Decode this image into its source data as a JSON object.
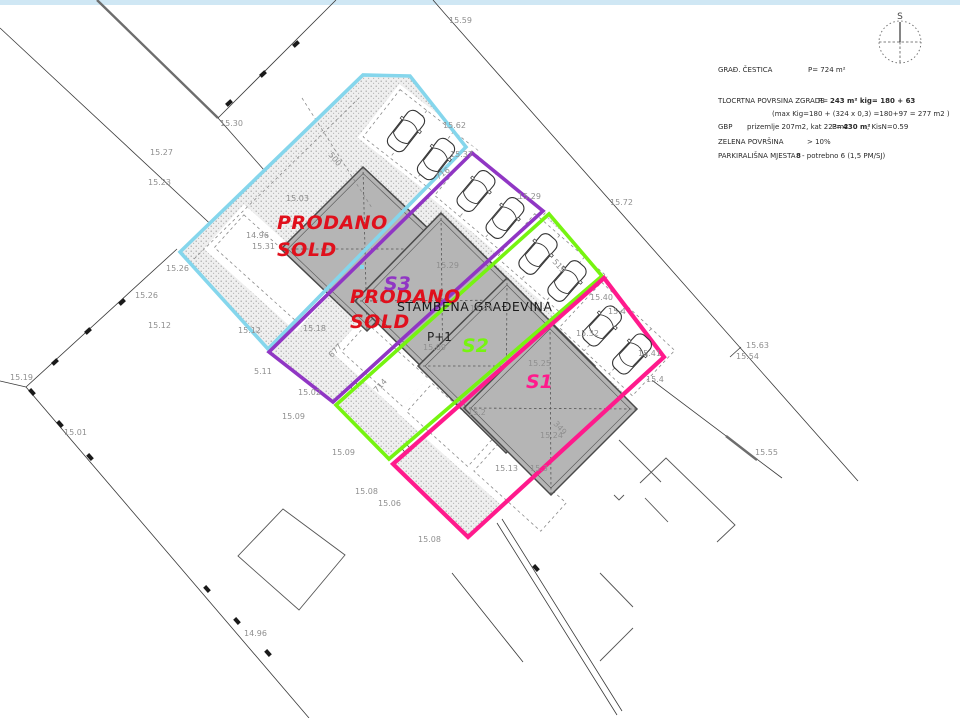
{
  "colors": {
    "sold_red": "#e0101c",
    "plot_cyan": "#85d6ec",
    "plot_purple": "#9036c4",
    "plot_green": "#76f410",
    "plot_pink": "#ff1a8c",
    "building_gray": "#b5b5b5",
    "top_strip": "#cfe7f4"
  },
  "texts": {
    "prodano1_line1": "PRODANO",
    "prodano1_line2": "SOLD",
    "prodano2_line1": "PRODANO",
    "prodano2_line2": "SOLD",
    "s1": "S1",
    "s2": "S2",
    "s3": "S3",
    "building": "STAMBENA GRAĐEVINA",
    "floors": "P+1",
    "compass": "S"
  },
  "info": {
    "row1_label": "GRAĐ. ČESTICA",
    "row1_value": "P= 724 m²",
    "row2_label": "TLOCRTNA POVRSINA ZGRADE",
    "row2_p": "P=",
    "row2_value": "243 m² kig= 180 + 63",
    "row3": "(max Kig=180 + (324 x 0,3) =180+97 = 277 m2 )",
    "row4_label": "GBP",
    "row4_detail": "prizemlje 207m2, kat 223m2",
    "row4_p": "P=",
    "row4_value": "430 m²",
    "row4_suffix": ", KisN=0.59",
    "row5_label": "ZELENA POVRŠINA",
    "row5_value": "> 10%",
    "row6_label": "PARKIRALIŠNA MJESTA",
    "row6_value": "8",
    "row6_suffix": "- potrebno 6 (1,5 PM/SJ)"
  },
  "elevations": [
    {
      "t": "15.62",
      "x": 443,
      "y": 128
    },
    {
      "t": "15.59",
      "x": 449,
      "y": 23
    },
    {
      "t": "15.30",
      "x": 220,
      "y": 126
    },
    {
      "t": "15.31",
      "x": 252,
      "y": 249
    },
    {
      "t": "15.27",
      "x": 150,
      "y": 155
    },
    {
      "t": "15.23",
      "x": 148,
      "y": 185
    },
    {
      "t": "15.26",
      "x": 135,
      "y": 298
    },
    {
      "t": "15.12",
      "x": 148,
      "y": 328
    },
    {
      "t": "15.12",
      "x": 238,
      "y": 333
    },
    {
      "t": "5.11",
      "x": 254,
      "y": 374
    },
    {
      "t": "15.19",
      "x": 10,
      "y": 380
    },
    {
      "t": "15.01",
      "x": 64,
      "y": 435
    },
    {
      "t": "14.96",
      "x": 244,
      "y": 636
    },
    {
      "t": "15.03",
      "x": 286,
      "y": 201
    },
    {
      "t": "14.96",
      "x": 246,
      "y": 238
    },
    {
      "t": "15.26",
      "x": 166,
      "y": 271
    },
    {
      "t": "15.18",
      "x": 303,
      "y": 331
    },
    {
      "t": "15.02",
      "x": 298,
      "y": 395
    },
    {
      "t": "15.09",
      "x": 282,
      "y": 419
    },
    {
      "t": "15.09",
      "x": 332,
      "y": 455
    },
    {
      "t": "15.08",
      "x": 355,
      "y": 494
    },
    {
      "t": "15.06",
      "x": 378,
      "y": 506
    },
    {
      "t": "15.08",
      "x": 418,
      "y": 542
    },
    {
      "t": "15.29",
      "x": 436,
      "y": 268
    },
    {
      "t": "15.09",
      "x": 423,
      "y": 350
    },
    {
      "t": "15.2",
      "x": 468,
      "y": 415
    },
    {
      "t": "15.25",
      "x": 528,
      "y": 366
    },
    {
      "t": "15.29",
      "x": 470,
      "y": 311
    },
    {
      "t": "15.37",
      "x": 450,
      "y": 157
    },
    {
      "t": "15.29",
      "x": 518,
      "y": 199
    },
    {
      "t": "15.40",
      "x": 590,
      "y": 300
    },
    {
      "t": "15.4",
      "x": 608,
      "y": 314
    },
    {
      "t": "15.32",
      "x": 576,
      "y": 336
    },
    {
      "t": "15.41",
      "x": 638,
      "y": 356
    },
    {
      "t": "15.4",
      "x": 646,
      "y": 382
    },
    {
      "t": "15.72",
      "x": 610,
      "y": 205
    },
    {
      "t": "15.63",
      "x": 746,
      "y": 348
    },
    {
      "t": "15.54",
      "x": 736,
      "y": 359
    },
    {
      "t": "15.55",
      "x": 755,
      "y": 455
    },
    {
      "t": "15.13",
      "x": 495,
      "y": 471
    },
    {
      "t": "15.3",
      "x": 530,
      "y": 471
    },
    {
      "t": "15.24",
      "x": 540,
      "y": 438
    }
  ],
  "dimensions": [
    {
      "t": "500",
      "x": 328,
      "y": 155,
      "r": 50
    },
    {
      "t": "716",
      "x": 438,
      "y": 180,
      "r": -35
    },
    {
      "t": "677",
      "x": 332,
      "y": 358,
      "r": -47
    },
    {
      "t": "714",
      "x": 377,
      "y": 393,
      "r": -47
    },
    {
      "t": "349",
      "x": 553,
      "y": 424,
      "r": 48
    },
    {
      "t": "519",
      "x": 552,
      "y": 262,
      "r": 48
    }
  ]
}
